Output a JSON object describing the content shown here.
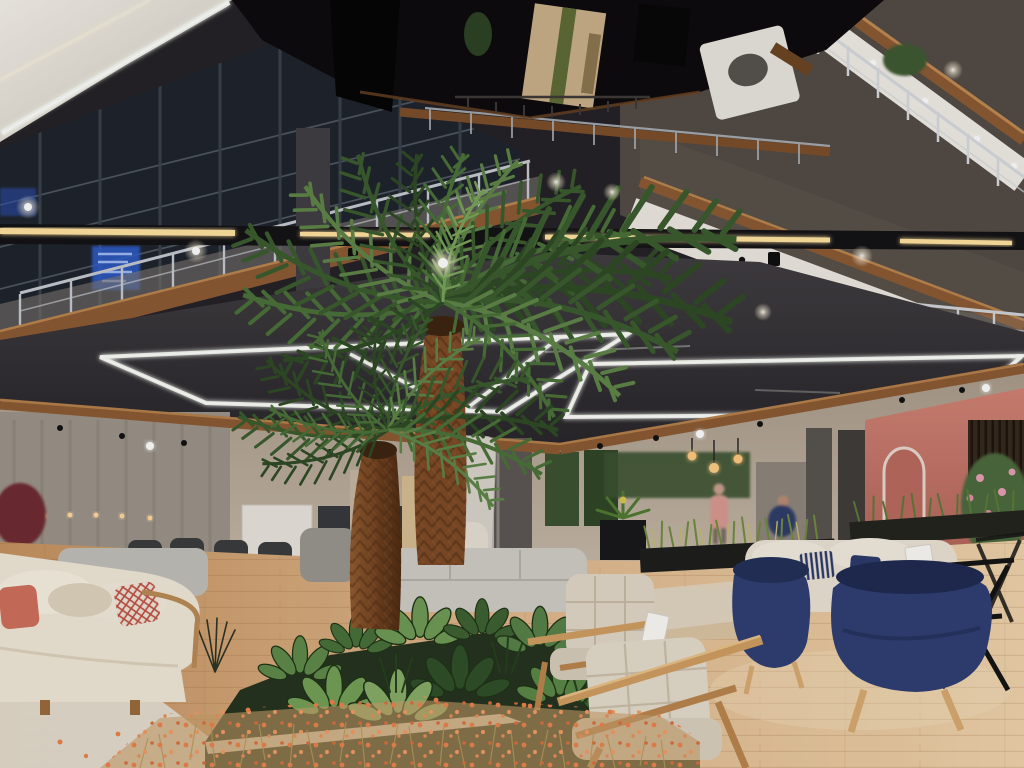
{
  "image": {
    "alt": "Photograph of a multi-storey furniture showroom atrium: mirrored black ceiling, balconies with chrome railings and wood trim, suspended white LED light frames, two artificial palm trees in a central planter with orange wildflowers, cream and navy sofas and oak armchairs on a light wood floor, salmon-pink accent wall at right",
    "width": 1024,
    "height": 768
  },
  "palette": {
    "ceiling_mirror": "#0b0a0c",
    "wall_upper": "#514b45",
    "wall_upper2": "#585149",
    "window_glass": "#1e242d",
    "wood_trim": "#8a5a33",
    "wood_trim_hi": "#c08a52",
    "led_cool": "#f4f8ef",
    "led_warm": "#ffe3a1",
    "soffit": "#38363b",
    "beam": "#121214",
    "back_wall": "#b5a897",
    "curtain_wall": "#9b948a",
    "pink_wall": "#cd8172",
    "slat_wall": "#34291f",
    "living_wall": "#3a5230",
    "column": "#5b5753",
    "floor_left": "#c99a6d",
    "floor_right": "#ecd2ae",
    "planter_soil": "#253320",
    "curb": "#d9cfb9",
    "palm_frond": "#4a7239",
    "palm_frond_dark": "#2e4b25",
    "palm_trunk": "#7c4a26",
    "flower_orange": "#e8834d",
    "sofa_cream": "#efe8d8",
    "sofa_grey": "#c0bfb9",
    "armchair_beige": "#e0d8c7",
    "oak": "#cf9f62",
    "navy": "#2e3f74",
    "pillow_coral": "#cf6f5d",
    "sign_blue": "#2f5fd0",
    "chrome": "#d6dade",
    "rug": "#e7e3d8",
    "tag_white": "#fbfaf6",
    "person_pink": "#d89a92",
    "person_navy": "#2e3d6b"
  },
  "scene": {
    "setting": "indoor furniture store atrium, three visible balcony levels, evening artificial lighting",
    "objects": [
      {
        "name": "mirrored-black-ceiling",
        "color": "#0b0a0c"
      },
      {
        "name": "led-light-frames",
        "color": "#f4f8ef"
      },
      {
        "name": "track-beam-warm-led",
        "color": "#ffe3a1"
      },
      {
        "name": "balcony-railings-chrome",
        "color": "#d6dade"
      },
      {
        "name": "wood-floor-trims",
        "color": "#8a5a33"
      },
      {
        "name": "artificial-palm-trees",
        "color": "#4a7239"
      },
      {
        "name": "central-planter-bed",
        "color": "#253320"
      },
      {
        "name": "orange-wildflowers",
        "color": "#e8834d"
      },
      {
        "name": "cream-sofas",
        "color": "#efe8d8"
      },
      {
        "name": "navy-armchairs",
        "color": "#2e3f74"
      },
      {
        "name": "oak-frame-armchairs",
        "color": "#e0d8c7"
      },
      {
        "name": "pink-accent-wall",
        "color": "#cd8172"
      },
      {
        "name": "blue-led-signs",
        "color": "#2f5fd0"
      },
      {
        "name": "shoppers-in-background",
        "color": "#d89a92"
      }
    ]
  }
}
